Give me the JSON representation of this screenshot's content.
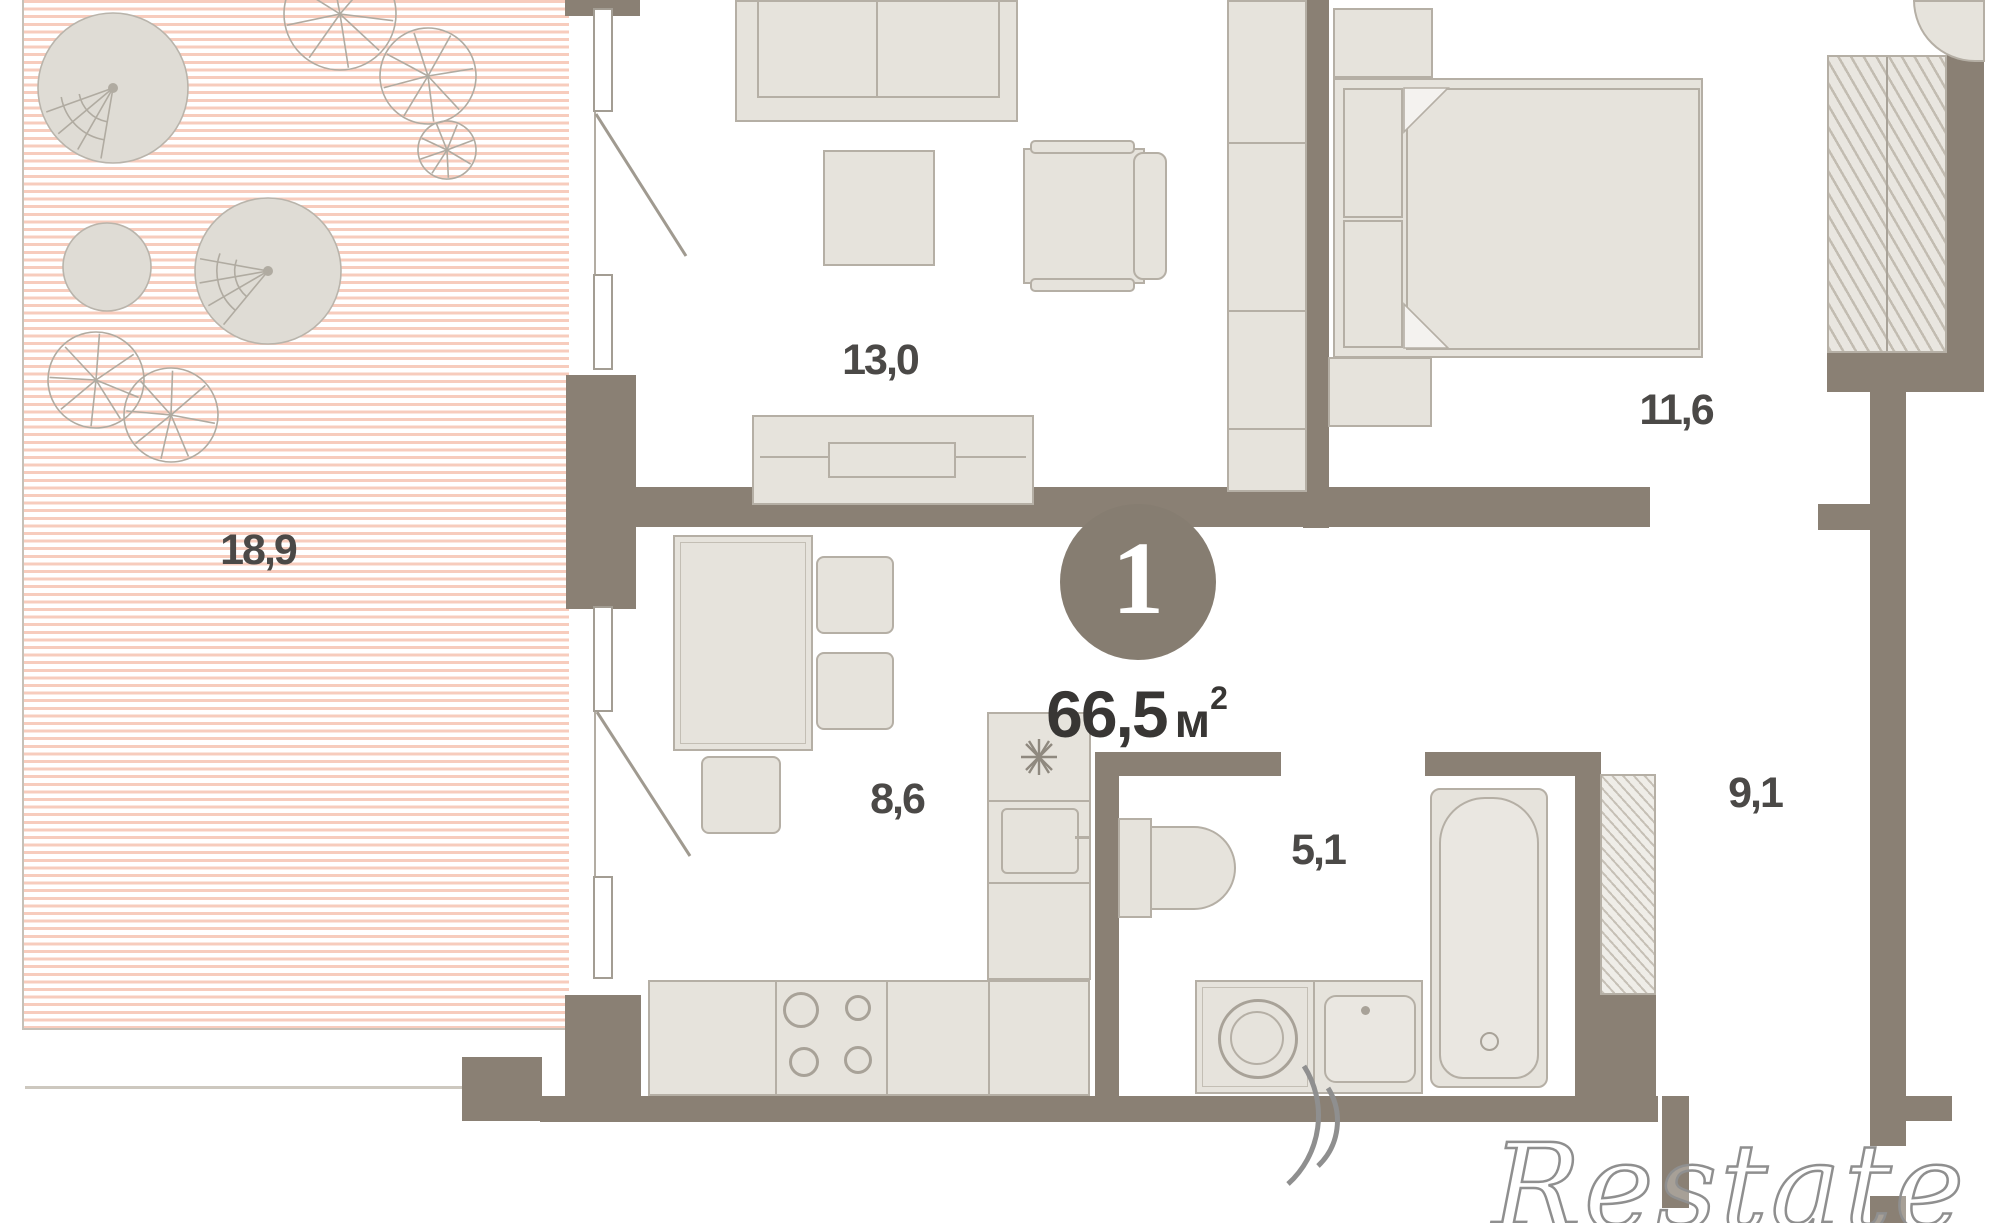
{
  "plan": {
    "unit_badge": "1",
    "total_area_value": "66,5",
    "total_area_unit": "м",
    "total_area_sup": "2"
  },
  "rooms": {
    "terrace_area": "18,9",
    "living_area": "13,0",
    "bedroom_area": "11,6",
    "kitchen_area": "8,6",
    "bathroom_area": "5,1",
    "hall_area": "9,1"
  },
  "watermark_text": "Restate",
  "colors": {
    "wall": "#8a8074",
    "terrace_stripe": "#f7ccbd",
    "badge": "#867d71",
    "furniture": "#e6e3dc"
  }
}
